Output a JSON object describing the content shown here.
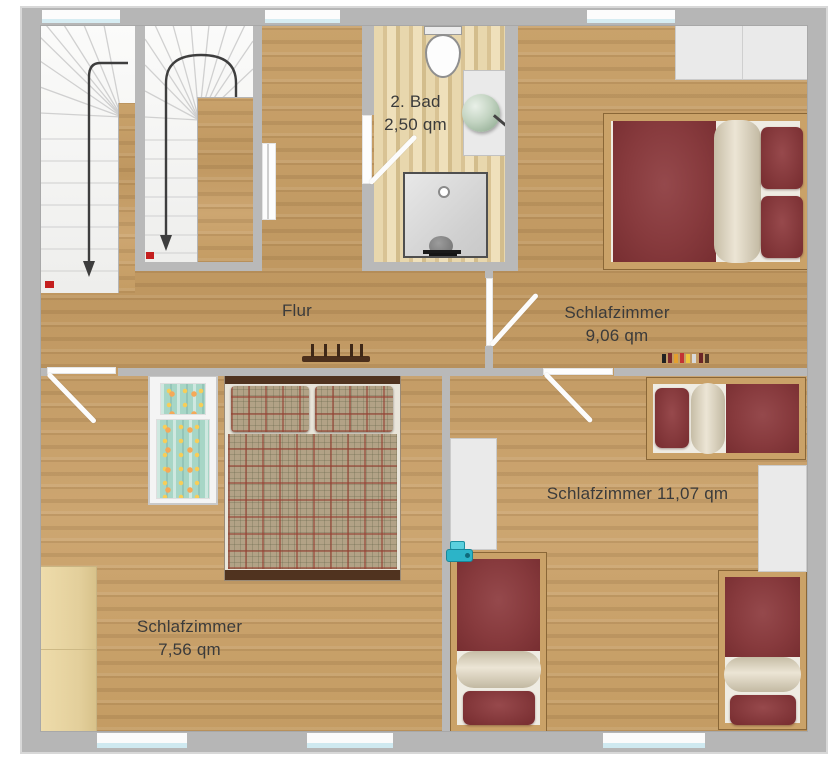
{
  "floorplan": {
    "rooms": [
      {
        "id": "bad",
        "name": "2. Bad",
        "area": "2,50 qm"
      },
      {
        "id": "flur",
        "name": "Flur",
        "area": ""
      },
      {
        "id": "schlafzimmer-9",
        "name": "Schlafzimmer",
        "area": "9,06 qm"
      },
      {
        "id": "schlafzimmer-11",
        "name": "Schlafzimmer 11,07 qm",
        "area": ""
      },
      {
        "id": "schlafzimmer-7",
        "name": "Schlafzimmer",
        "area": "7,56 qm"
      }
    ],
    "furniture": [
      "staircase",
      "staircase",
      "toilet",
      "washbasin",
      "shower",
      "wardrobe",
      "double-bed",
      "single-bed",
      "single-bed",
      "single-bed",
      "double-bed",
      "crib",
      "wardrobe",
      "wardrobe",
      "wardrobe",
      "coat-rack",
      "toys"
    ],
    "colors": {
      "wall": "#b9b9b9",
      "wall_outline": "#d8d8d8",
      "floor_wood": "#c59e67",
      "bathroom_floor": "#e2cfa2",
      "bed_maroon": "#8a3c40",
      "blanket_beige": "#e7dfce",
      "bed_frame_wood": "#caa268",
      "plaid_base": "#b2a286",
      "wardrobe_gray": "#eaeaea",
      "wardrobe_beige": "#e9d6a5",
      "basin_green": "#b7cbb7",
      "toy_teal": "#2cb4c8",
      "stair_marker_red": "#c41f1f",
      "window_glass": "#d6ecf2",
      "label_text": "#3b3b3b"
    }
  }
}
